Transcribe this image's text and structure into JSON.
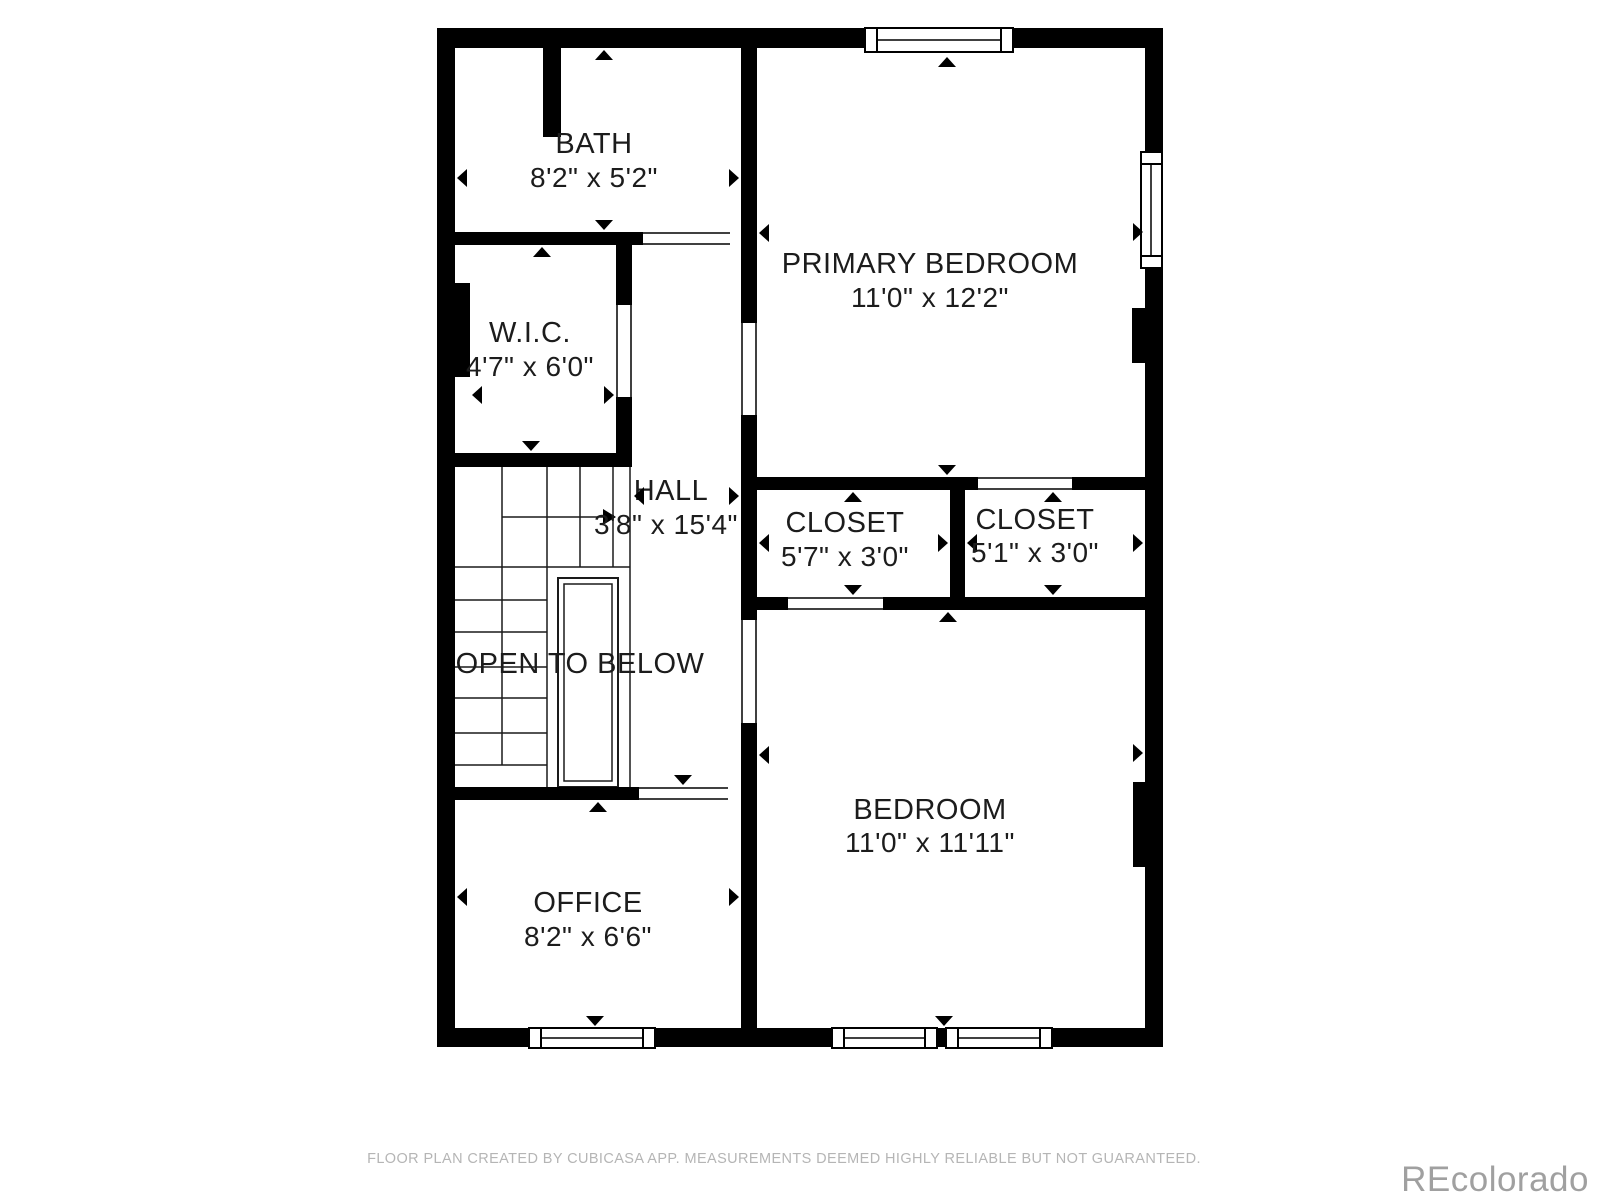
{
  "rooms": [
    {
      "name": "BATH",
      "dims": "8'2\" x 5'2\""
    },
    {
      "name": "W.I.C.",
      "dims": "4'7\" x 6'0\""
    },
    {
      "name": "PRIMARY BEDROOM",
      "dims": "11'0\" x 12'2\""
    },
    {
      "name": "HALL",
      "dims": "3'8\" x 15'4\""
    },
    {
      "name": "CLOSET",
      "dims": "5'7\" x 3'0\""
    },
    {
      "name": "CLOSET",
      "dims": "5'1\" x 3'0\""
    },
    {
      "name": "OPEN TO BELOW",
      "dims": ""
    },
    {
      "name": "BEDROOM",
      "dims": "11'0\" x 11'11\""
    },
    {
      "name": "OFFICE",
      "dims": "8'2\" x 6'6\""
    }
  ],
  "footer": {
    "disclaimer": "FLOOR PLAN CREATED BY CUBICASA APP. MEASUREMENTS DEEMED HIGHLY RELIABLE BUT NOT GUARANTEED."
  },
  "watermark": "REcolorado",
  "colors": {
    "wall": "#000000",
    "background": "#ffffff",
    "label_text": "#1c1c1c",
    "footer_text": "#b5b5b5",
    "watermark_text": "#a0a0a0"
  }
}
